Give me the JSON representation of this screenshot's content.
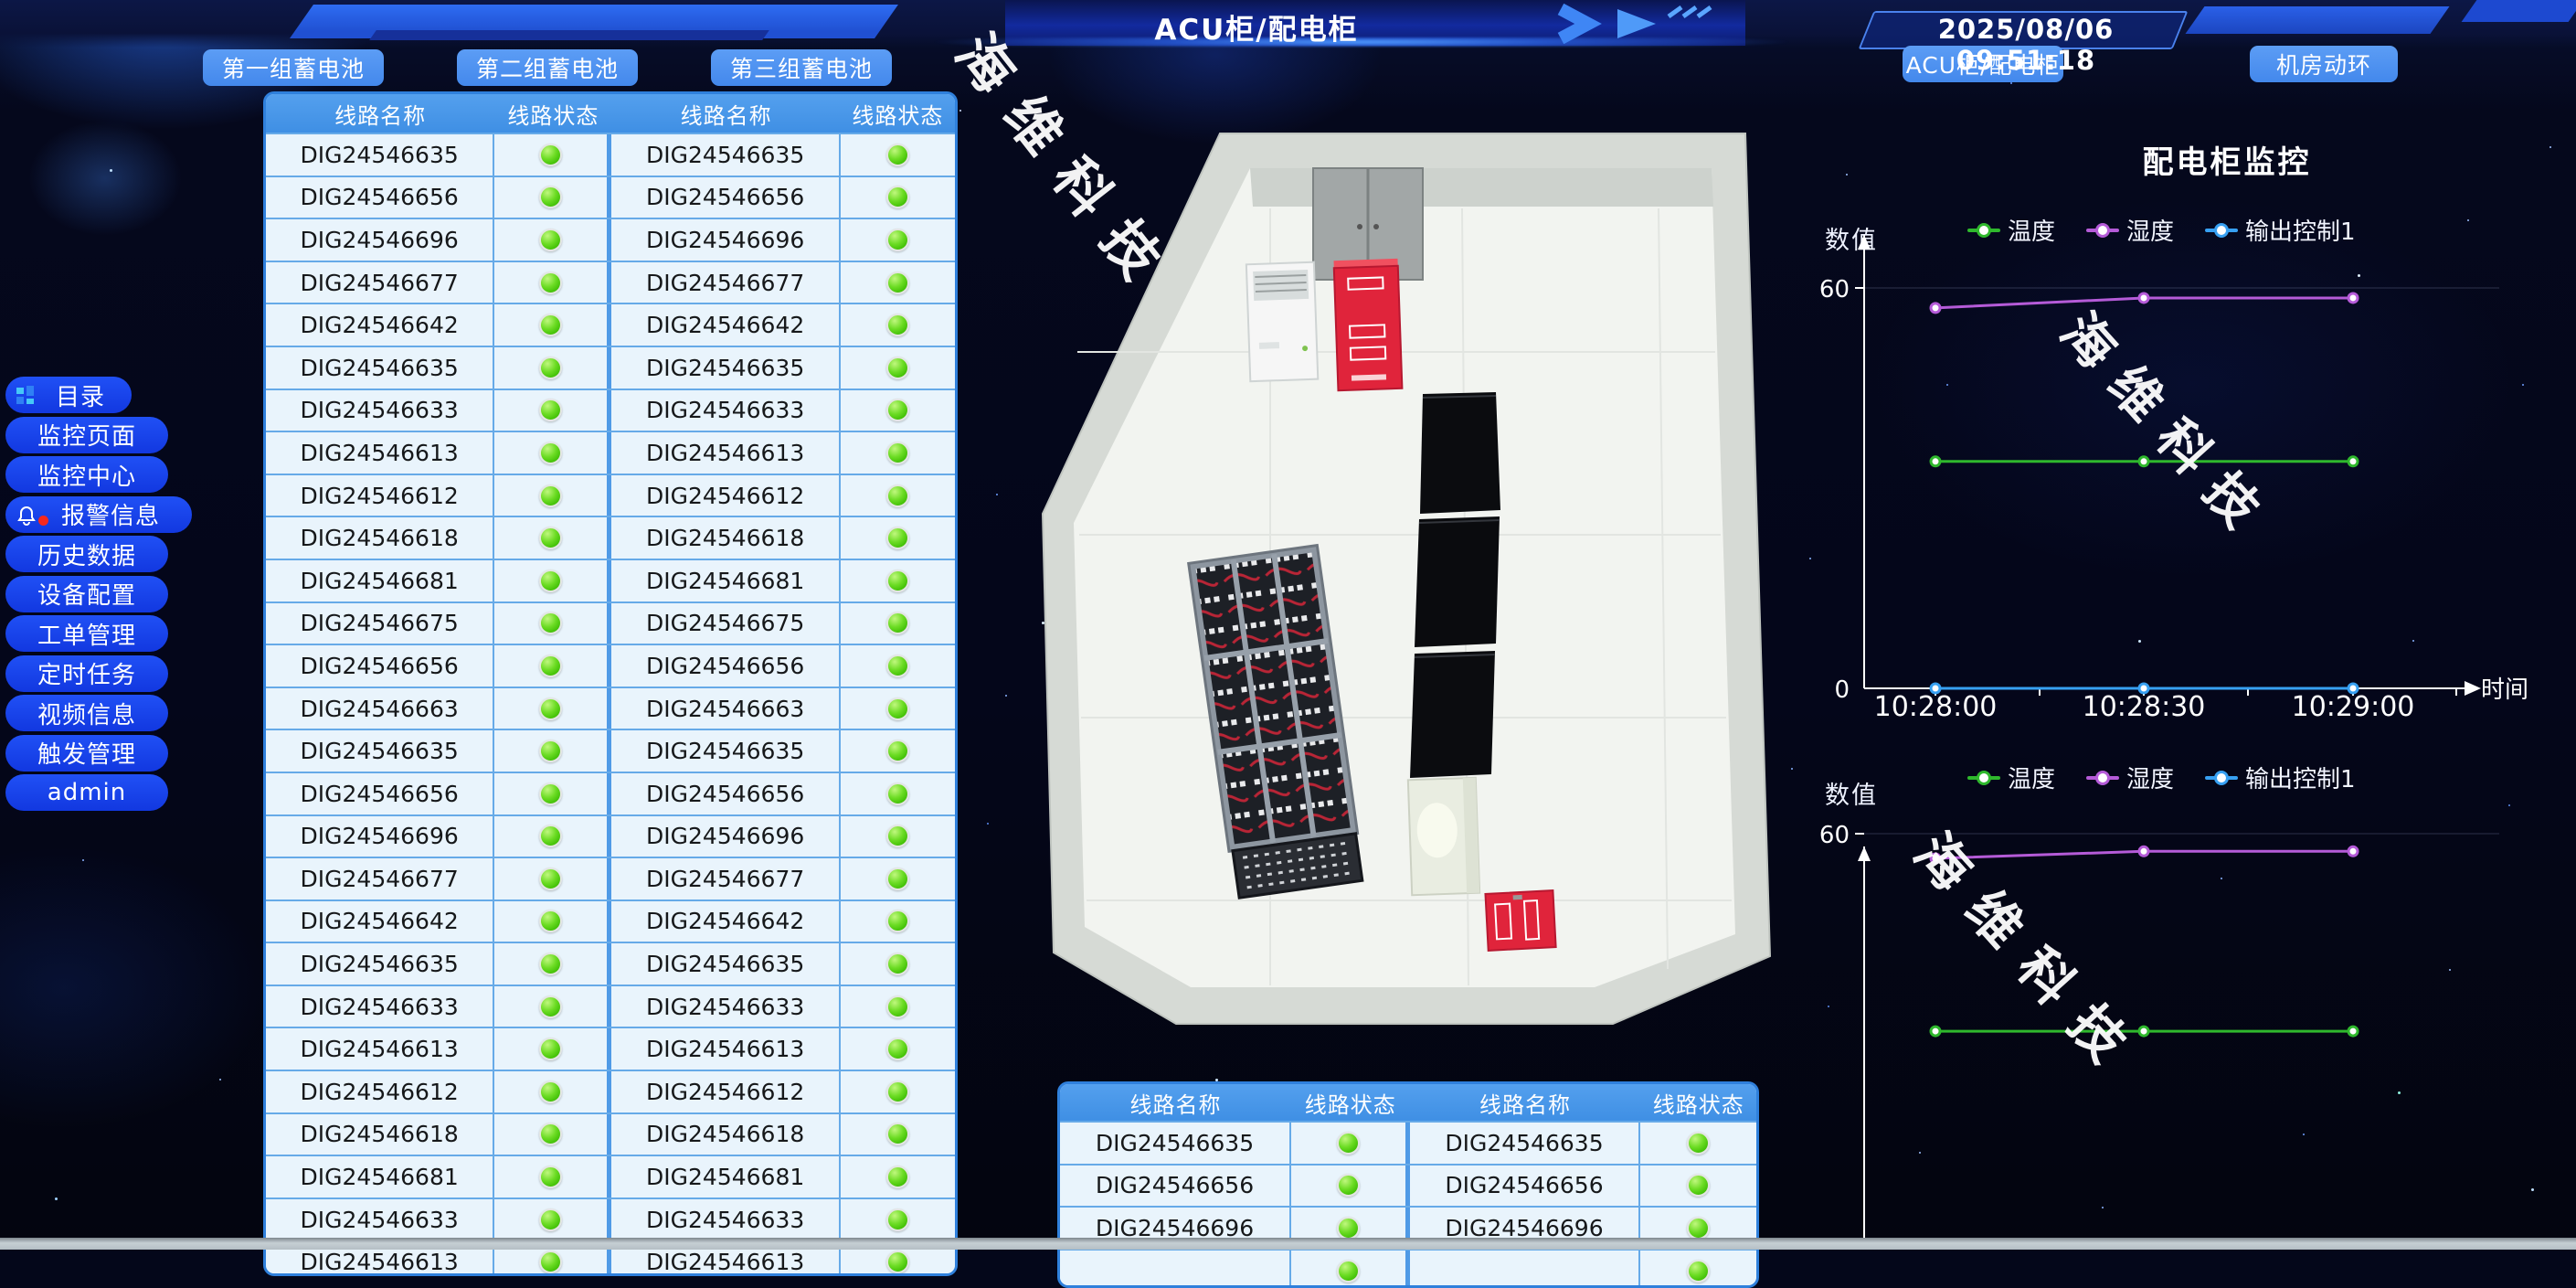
{
  "header": {
    "title": "ACU柜/配电柜",
    "datetime": "2025/08/06 09:51:18"
  },
  "nav": {
    "battery_buttons": [
      "第一组蓄电池",
      "第二组蓄电池",
      "第三组蓄电池"
    ],
    "page_buttons": [
      "ACU柜/配电柜",
      "机房动环"
    ]
  },
  "sidebar": {
    "items": [
      {
        "label": "目录",
        "icon": "menu-grid-icon"
      },
      {
        "label": "监控页面"
      },
      {
        "label": "监控中心"
      },
      {
        "label": "报警信息",
        "icon": "alarm-bell-icon",
        "badge_color": "#f5281e"
      },
      {
        "label": "历史数据"
      },
      {
        "label": "设备配置"
      },
      {
        "label": "工单管理"
      },
      {
        "label": "定时任务"
      },
      {
        "label": "视频信息"
      },
      {
        "label": "触发管理"
      },
      {
        "label": "admin"
      }
    ]
  },
  "tables": {
    "headers": [
      "线路名称",
      "线路状态",
      "线路名称",
      "线路状态"
    ],
    "status_ok_color": "#52cd11",
    "left_panel_rows": [
      "DIG24546635",
      "DIG24546656",
      "DIG24546696",
      "DIG24546677",
      "DIG24546642",
      "DIG24546635",
      "DIG24546633",
      "DIG24546613",
      "DIG24546612",
      "DIG24546618",
      "DIG24546681",
      "DIG24546675",
      "DIG24546656",
      "DIG24546663",
      "DIG24546635",
      "DIG24546656",
      "DIG24546696",
      "DIG24546677",
      "DIG24546642",
      "DIG24546635",
      "DIG24546633",
      "DIG24546613",
      "DIG24546612",
      "DIG24546618",
      "DIG24546681",
      "DIG24546633",
      "DIG24546613",
      "DIG24546612"
    ],
    "bottom_panel_rows": [
      "DIG24546635",
      "DIG24546656",
      "DIG24546696",
      ""
    ]
  },
  "monitor": {
    "title": "配电柜监控"
  },
  "watermark": {
    "text": "海维科技"
  },
  "chart_data": [
    {
      "type": "line",
      "ylabel": "数值",
      "xlabel": "时间",
      "ylim": [
        0,
        60
      ],
      "ymax_label": "60",
      "ymin_label": "0",
      "x": [
        "10:28:00",
        "10:28:30",
        "10:29:00"
      ],
      "series": [
        {
          "name": "温度",
          "color": "#2fb82d",
          "values": [
            34,
            34,
            34
          ]
        },
        {
          "name": "湿度",
          "color": "#b55bd8",
          "values": [
            57,
            58.5,
            58.5
          ]
        },
        {
          "name": "输出控制1",
          "color": "#37a0f2",
          "values": [
            0,
            0,
            0
          ]
        }
      ]
    },
    {
      "type": "line",
      "ylabel": "数值",
      "xlabel": "",
      "ylim": [
        0,
        60
      ],
      "ymax_label": "60",
      "ymin_label": "",
      "x": [],
      "series": [
        {
          "name": "温度",
          "color": "#2fb82d",
          "values": [
            32,
            32,
            32
          ]
        },
        {
          "name": "湿度",
          "color": "#b55bd8",
          "values": [
            56.5,
            57.5,
            57.5
          ]
        },
        {
          "name": "输出控制1",
          "color": "#37a0f2",
          "values": [
            0,
            0,
            0
          ]
        }
      ]
    }
  ]
}
